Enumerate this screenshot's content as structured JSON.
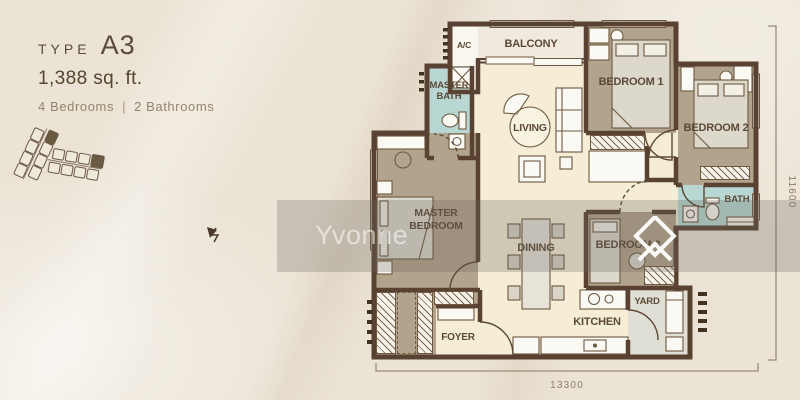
{
  "header": {
    "type_label": "TYPE",
    "type_value": "A3",
    "area": "1,388 sq. ft.",
    "bedrooms": "4 Bedrooms",
    "divider": "|",
    "bathrooms": "2 Bathrooms"
  },
  "floorplan": {
    "rooms": {
      "ac": "A/C",
      "balcony": "BALCONY",
      "master_bath_1": "MASTER",
      "master_bath_2": "BATH",
      "living": "LIVING",
      "bedroom1": "BEDROOM 1",
      "bedroom2": "BEDROOM 2",
      "bath": "BATH",
      "master_bedroom_1": "MASTER",
      "master_bedroom_2": "BEDROOM",
      "dining": "DINING",
      "bedroom3": "BEDROOM 3",
      "yard": "YARD",
      "kitchen": "KITCHEN",
      "foyer": "FOYER"
    },
    "dimensions": {
      "width": "13300",
      "height": "11600"
    }
  },
  "watermark": {
    "text": "Yvonne"
  },
  "icons": {
    "logo": "double-chevron-diamond-logo",
    "north_arrow": "north-arrow",
    "key_plan": "site-key-plan"
  },
  "colors": {
    "background": "#ebe3d5",
    "wall": "#5a4232",
    "bedroom_floor": "#b2a48c",
    "bath_floor": "#b8d7d2",
    "living_floor": "#f5edd5",
    "balcony_floor": "#f0eade",
    "yard_floor": "#e0dfd6",
    "title_text": "#5a4a3a",
    "muted_text": "#95846c",
    "dimension_text": "#8d7d66",
    "watermark_logo": "#ffffff"
  }
}
